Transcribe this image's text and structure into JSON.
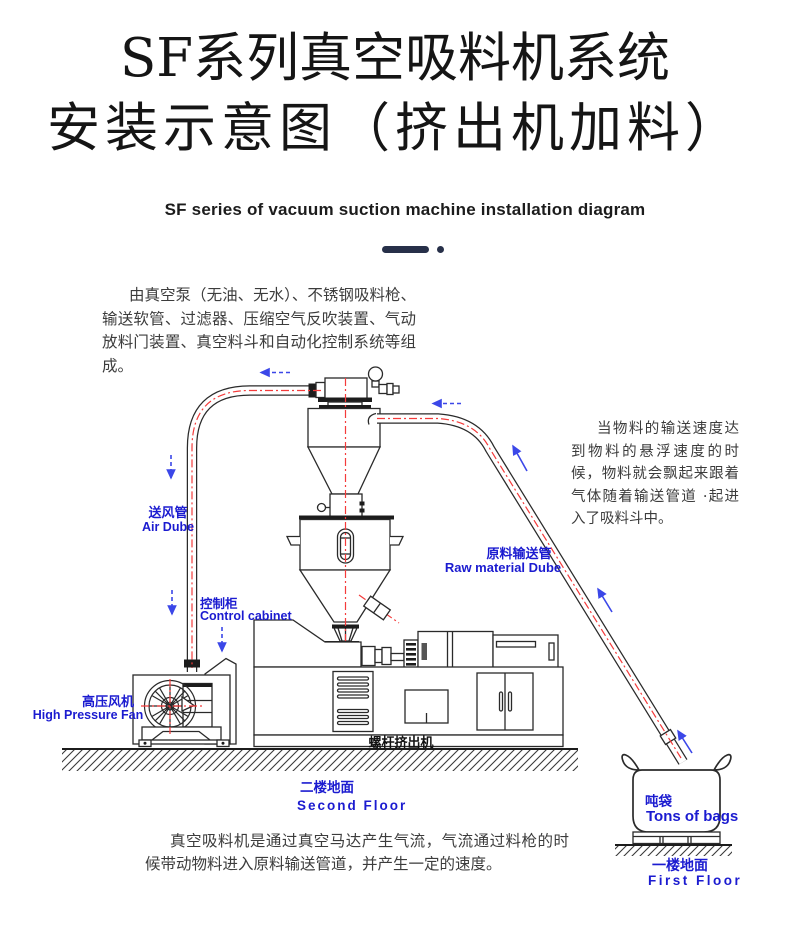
{
  "page": {
    "title_line1": "SF系列真空吸料机系统",
    "title_line2": "安装示意图（挤出机加料）",
    "subtitle_en": "SF series of vacuum suction machine installation diagram",
    "intro_paragraph": "由真空泵（无油、无水）、不锈钢吸料枪、输送软管、过滤器、压缩空气反吹装置、气动放料门装置、真空料斗和自动化控制系统等组成。",
    "side_note": "当物料的输送速度达到物料的悬浮速度的时候，物料就会飘起来跟着气体随着输送管道 ·起进入了吸料斗中。",
    "bottom_note": "真空吸料机是通过真空马达产生气流，气流通过料枪的时候带动物料进入原料输送管道，并产生一定的速度。"
  },
  "diagram": {
    "labels": {
      "air_pipe_cn": "送风管",
      "air_pipe_en": "Air Dube",
      "control_cabinet_cn": "控制柜",
      "control_cabinet_en": "Control cabinet",
      "fan_cn": "高压风机",
      "fan_en": "High Pressure Fan",
      "raw_pipe_cn": "原料输送管",
      "raw_pipe_en": "Raw material Dube",
      "extruder_cn": "螺杆挤出机",
      "floor2_cn": "二楼地面",
      "floor2_en": "Second Floor",
      "bag_cn": "吨袋",
      "bag_en": "Tons of bags",
      "floor1_cn": "一楼地面",
      "floor1_en": "First Floor"
    },
    "colors": {
      "label_blue": "#1b1bd0",
      "pipe_red": "#f43b3b",
      "arrow_blue": "#3b47e8",
      "line_black": "#2a2a2a",
      "divider_navy": "#273049"
    }
  }
}
